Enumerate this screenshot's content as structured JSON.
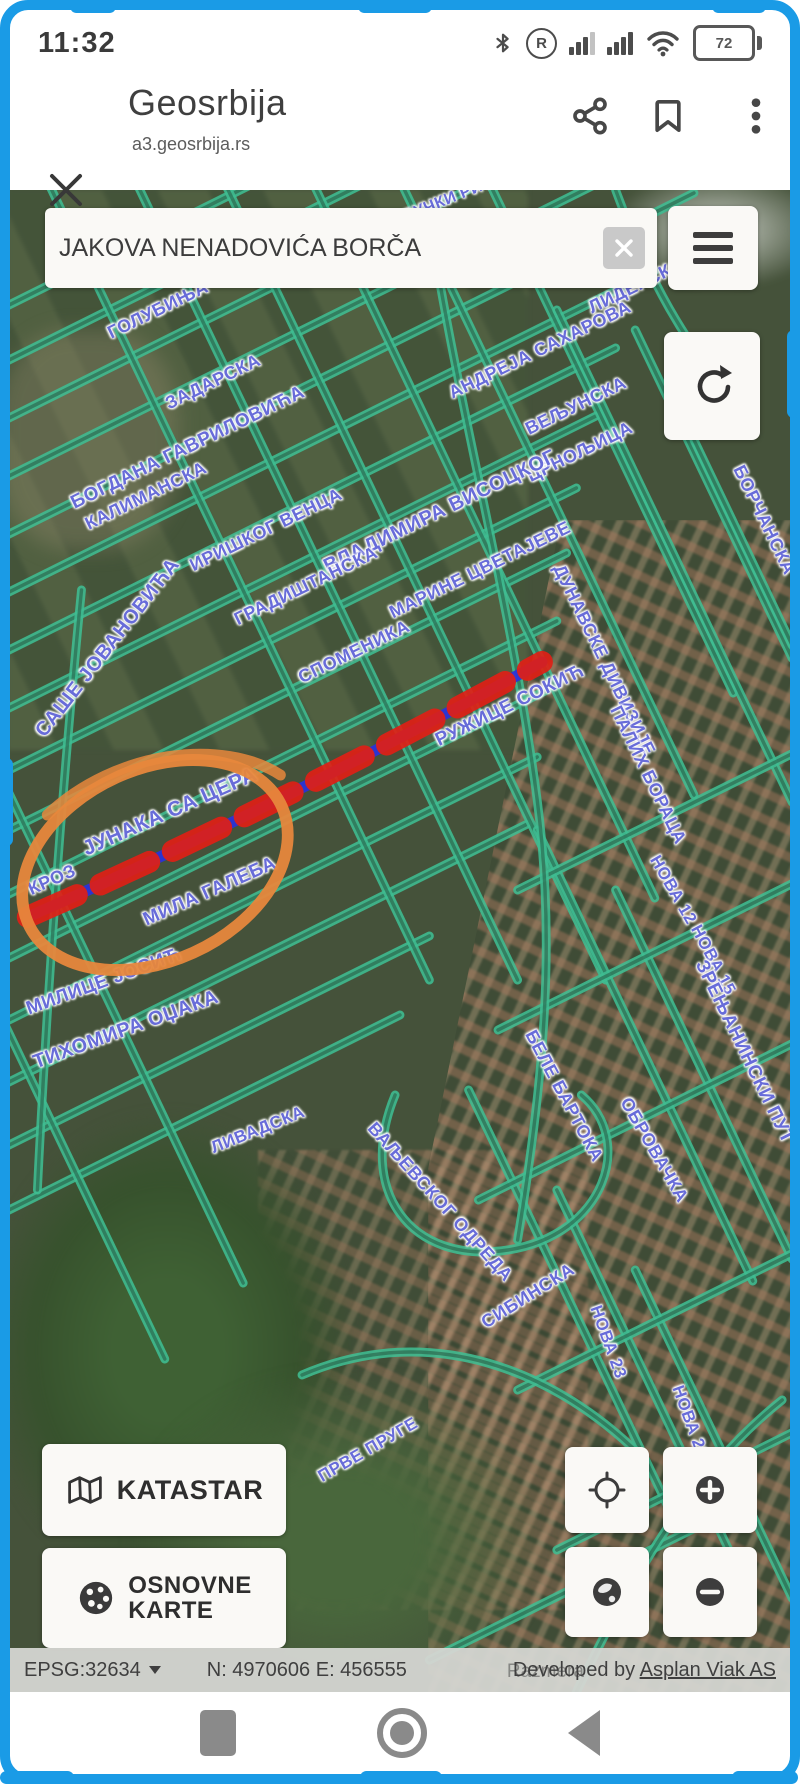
{
  "status_bar": {
    "time": "11:32",
    "roaming": "R",
    "battery_percent": "72",
    "icons": [
      "bluetooth-icon",
      "roaming-icon",
      "cell-signal-icon",
      "cell-signal-icon-2",
      "wifi-icon",
      "battery-icon"
    ]
  },
  "browser": {
    "title": "Geosrbija",
    "url": "a3.geosrbija.rs",
    "icons": [
      "close-icon",
      "share-icon",
      "bookmark-icon",
      "kebab-menu-icon"
    ]
  },
  "search": {
    "value": "JAKOVA NENADOVIĆA BORČA",
    "icons": [
      "clear-icon"
    ]
  },
  "map": {
    "colors": {
      "street": "#3fbd92",
      "street_core": "rgba(32,62,46,0.55)",
      "label": "#5d61d6",
      "highlight_red": "#e01f16",
      "highlight_blue": "#2a33d8",
      "annotation_orange": "#e7873c"
    },
    "labels": [
      [
        "ЈАБУЧКИ РИТ",
        430,
        14,
        -22,
        16
      ],
      [
        "ГОЛУБИЊА",
        150,
        120,
        -26,
        18
      ],
      [
        "ЗАДАРСКА",
        205,
        192,
        -26,
        18
      ],
      [
        "БОГДАНА ГАВРИЛОВИЋА",
        180,
        258,
        -26,
        19
      ],
      [
        "ЛИДЕРСКА",
        628,
        96,
        -26,
        18
      ],
      [
        "АНДРЕЈА САХАРОВА",
        532,
        160,
        -26,
        18
      ],
      [
        "ВЕЉУНСКА",
        568,
        216,
        -26,
        18
      ],
      [
        "ЦРНОЉИЦА",
        572,
        262,
        -26,
        18
      ],
      [
        "КАЛИМАНСКА",
        138,
        306,
        -26,
        18
      ],
      [
        "ИРИШКОГ ВЕНЦА",
        258,
        340,
        -26,
        18
      ],
      [
        "ВЛАДИМИРА ВИСОЦКОГ",
        432,
        322,
        -26,
        20
      ],
      [
        "МАРИНЕ ЦВЕТАЈЕВЕ",
        472,
        380,
        -26,
        18
      ],
      [
        "ГРАДИШТАНСКА",
        298,
        396,
        -26,
        18
      ],
      [
        "СПОМЕНИКА",
        346,
        462,
        -26,
        18
      ],
      [
        "РУЖИЦЕ СОКИЋ",
        502,
        516,
        -26,
        19
      ],
      [
        "САШЕ ЈОВАНОВИЋА",
        100,
        458,
        -52,
        20
      ],
      [
        "ЈУНАКА СА ЦЕРА",
        162,
        622,
        -24,
        21
      ],
      [
        "КРОЗ",
        44,
        690,
        -24,
        18
      ],
      [
        "МИЛА ГАЛЕБА",
        202,
        702,
        -24,
        19
      ],
      [
        "МИЛИЦЕ ЈОСИЋ",
        96,
        792,
        -20,
        19
      ],
      [
        "ТИХОМИРА ОЏАКА",
        118,
        840,
        -20,
        20
      ],
      [
        "БОРЧАНСКА",
        756,
        330,
        64,
        18
      ],
      [
        "ДУНАВСКЕ ДИВИЗИЈЕ",
        596,
        470,
        64,
        18
      ],
      [
        "ПАЛИХ БОРАЦА",
        640,
        585,
        64,
        18
      ],
      [
        "НОВА 12",
        665,
        700,
        60,
        17
      ],
      [
        "НОВА 15",
        705,
        770,
        62,
        17
      ],
      [
        "БЕЛЕ БАРТОКА",
        556,
        906,
        62,
        18
      ],
      [
        "ОБРОВАЧКА",
        646,
        960,
        60,
        18
      ],
      [
        "ЗРЕЊАНИНСКИ ПУТ",
        736,
        862,
        64,
        19
      ],
      [
        "ВАЉЕВСКОГ ОДРЕДА",
        432,
        1012,
        48,
        18
      ],
      [
        "СИБИНСКА",
        520,
        1106,
        -32,
        18
      ],
      [
        "НОВА 23",
        600,
        1152,
        70,
        17
      ],
      [
        "НОВА 29",
        682,
        1232,
        70,
        17
      ],
      [
        "ПРВЕ ПРУГЕ",
        360,
        1260,
        -30,
        17
      ],
      [
        "ЛИВАДСКА",
        250,
        940,
        -22,
        17
      ]
    ],
    "streets": {
      "lines": [
        [
          -40,
          135,
          840,
          -294
        ],
        [
          -40,
          190,
          840,
          -239
        ],
        [
          -40,
          248,
          840,
          -181
        ],
        [
          -40,
          306,
          840,
          -123
        ],
        [
          -40,
          364,
          700,
          3
        ],
        [
          -40,
          422,
          660,
          81
        ],
        [
          -40,
          480,
          620,
          158
        ],
        [
          -40,
          538,
          600,
          226
        ],
        [
          -40,
          600,
          580,
          298
        ],
        [
          -40,
          660,
          570,
          363
        ],
        [
          -40,
          724,
          560,
          431
        ],
        [
          -40,
          788,
          550,
          500
        ],
        [
          -40,
          850,
          540,
          567
        ],
        [
          -40,
          912,
          530,
          634
        ],
        [
          -40,
          975,
          430,
          746
        ],
        [
          -40,
          1040,
          400,
          825
        ],
        [
          30,
          -30,
          430,
          790
        ],
        [
          120,
          -30,
          520,
          790
        ],
        [
          210,
          -30,
          610,
          790
        ],
        [
          300,
          -30,
          660,
          708
        ],
        [
          390,
          -30,
          700,
          605
        ],
        [
          480,
          -30,
          740,
          503
        ],
        [
          -20,
          560,
          240,
          1093
        ],
        [
          -20,
          800,
          160,
          1169
        ],
        [
          560,
          120,
          800,
          612
        ],
        [
          640,
          140,
          800,
          468
        ],
        [
          700,
          250,
          800,
          455
        ],
        [
          540,
          640,
          760,
          1091
        ],
        [
          620,
          700,
          800,
          1069
        ],
        [
          470,
          900,
          680,
          1330
        ],
        [
          560,
          1000,
          740,
          1369
        ],
        [
          640,
          1080,
          800,
          1408
        ],
        [
          520,
          700,
          820,
          554
        ],
        [
          500,
          840,
          820,
          684
        ],
        [
          480,
          1010,
          820,
          844
        ],
        [
          520,
          1200,
          820,
          1054
        ],
        [
          560,
          1360,
          820,
          1233
        ],
        [
          430,
          1470,
          740,
          1319
        ]
      ],
      "curves": [
        "M 430 30 C 460 220 515 420 540 610 C 560 760 545 900 520 1050",
        "M 395 905 C 355 1000 410 1075 510 1060 C 610 1045 640 950 585 905",
        "M 300 1185 C 430 1130 560 1180 650 1270",
        "M 580 1502 C 640 1380 700 1280 790 1210",
        "M 75 400 C 55 600 40 800 30 1000",
        "M 620 0 C 650 80 690 160 760 230"
      ]
    },
    "highlight": {
      "path": "M 20 727 C 200 650 380 560 545 472"
    },
    "annotation": {
      "cx": 150,
      "cy": 675,
      "rx": 142,
      "ry": 96,
      "rot": -24,
      "extra_stroke": "M 40 625 C 110 560 220 548 278 585"
    }
  },
  "controls": {
    "katastar_label": "KATASTAR",
    "osnovne_line1": "OSNOVNE",
    "osnovne_line2": "KARTE",
    "icons": [
      "hamburger-icon",
      "refresh-icon",
      "folded-map-icon",
      "dotted-globe-icon",
      "locate-icon",
      "zoom-in-icon",
      "globe-icon",
      "zoom-out-icon"
    ]
  },
  "status_line": {
    "epsg": "EPSG:32634",
    "coords": "N: 4970606 E: 456555",
    "developer_prefix": "Developed by",
    "developer_link": "Asplan Viak AS",
    "overlay_text": "Razmera"
  },
  "nav_bar": {
    "icons": [
      "recents-icon",
      "home-icon",
      "back-icon"
    ]
  }
}
